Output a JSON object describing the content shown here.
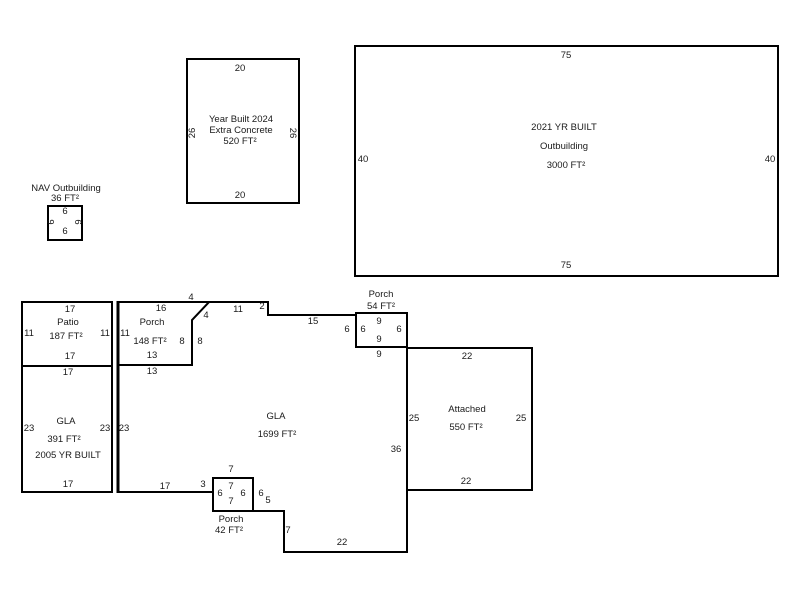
{
  "sketch": {
    "nav": {
      "title": "NAV Outbuilding",
      "area": "36 FT²",
      "top": "6",
      "left": "6",
      "right": "6",
      "bottom": "6"
    },
    "concrete": {
      "line1": "Year Built 2024",
      "line2": "Extra Concrete",
      "area": "520 FT²",
      "top": "20",
      "left": "26",
      "right": "26",
      "bottom": "20"
    },
    "outbuilding": {
      "line1": "2021 YR BUILT",
      "line2": "Outbuilding",
      "area": "3000 FT²",
      "top": "75",
      "left": "40",
      "right": "40",
      "bottom": "75"
    },
    "patio": {
      "title": "Patio",
      "area": "187 FT²",
      "top": "17",
      "left": "11",
      "right": "11",
      "bottom": "17"
    },
    "porch148": {
      "title": "Porch",
      "area": "148 FT²",
      "top": "16",
      "left": "11",
      "right_in": "8",
      "right_out": "8",
      "bottom": "13",
      "diag_top": "4",
      "diag_bottom": "4"
    },
    "gla391": {
      "title": "GLA",
      "area": "391 FT²",
      "year": "2005 YR BUILT",
      "top": "17",
      "left": "23",
      "right": "23",
      "bottom": "17"
    },
    "gla1699": {
      "title": "GLA",
      "area": "1699 FT²",
      "top_left": "13",
      "left": "23",
      "top_seg1": "11",
      "step_down": "2",
      "top_seg2": "15",
      "step2": "6",
      "top_seg3": "9",
      "right": "36",
      "bottom_seg3": "22",
      "jog_down": "7",
      "jog_top": "5",
      "porch_side": "6",
      "bottom_seg2": "3",
      "bottom_seg1": "17"
    },
    "porch54": {
      "title": "Porch",
      "area": "54 FT²",
      "top": "9",
      "left": "6",
      "right": "6",
      "bottom": "9"
    },
    "porch42": {
      "title": "Porch",
      "area": "42 FT²",
      "above": "7",
      "top": "7",
      "left": "6",
      "right": "6",
      "bottom": "7"
    },
    "attached": {
      "title": "Attached",
      "area": "550 FT²",
      "top": "22",
      "left": "25",
      "right": "25",
      "bottom": "22"
    }
  }
}
